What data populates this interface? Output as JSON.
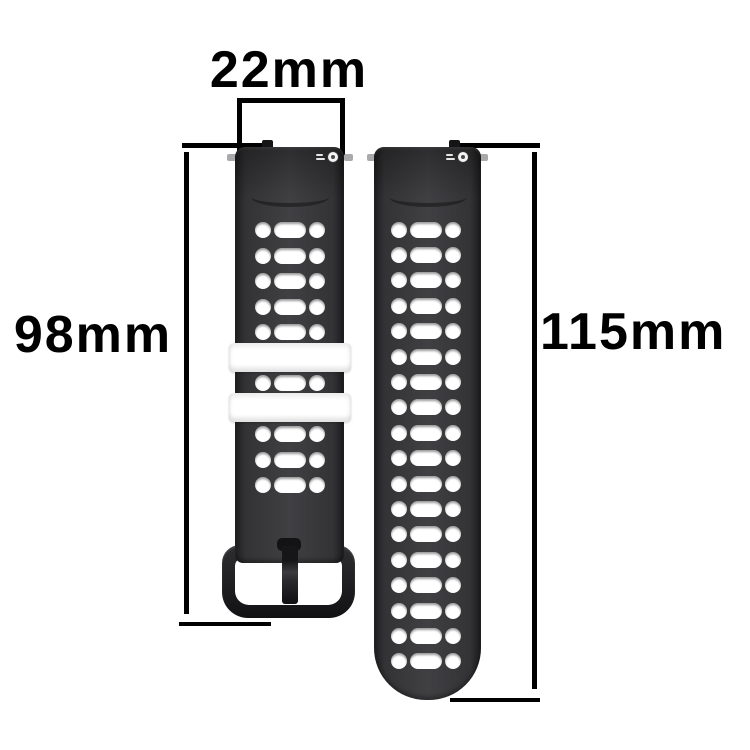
{
  "annotations": {
    "width_label": "22mm",
    "left_height_label": "98mm",
    "right_height_label": "115mm"
  },
  "product": {
    "type": "black silicone sport watch strap, two pieces, perforated",
    "left_strap": {
      "description": "short buckle-side strap",
      "hole_row_groups": [
        5,
        1,
        3
      ],
      "keeper_count": 2,
      "has_buckle": true
    },
    "right_strap": {
      "description": "long tail strap",
      "hole_row_count": 18
    }
  },
  "icons": {
    "logo": "comet-logo-icon"
  },
  "colors": {
    "background": "#ffffff",
    "strap": "#333335",
    "keeper": "#ffffff",
    "buckle": "#1d1d1f",
    "annotation": "#000000"
  }
}
